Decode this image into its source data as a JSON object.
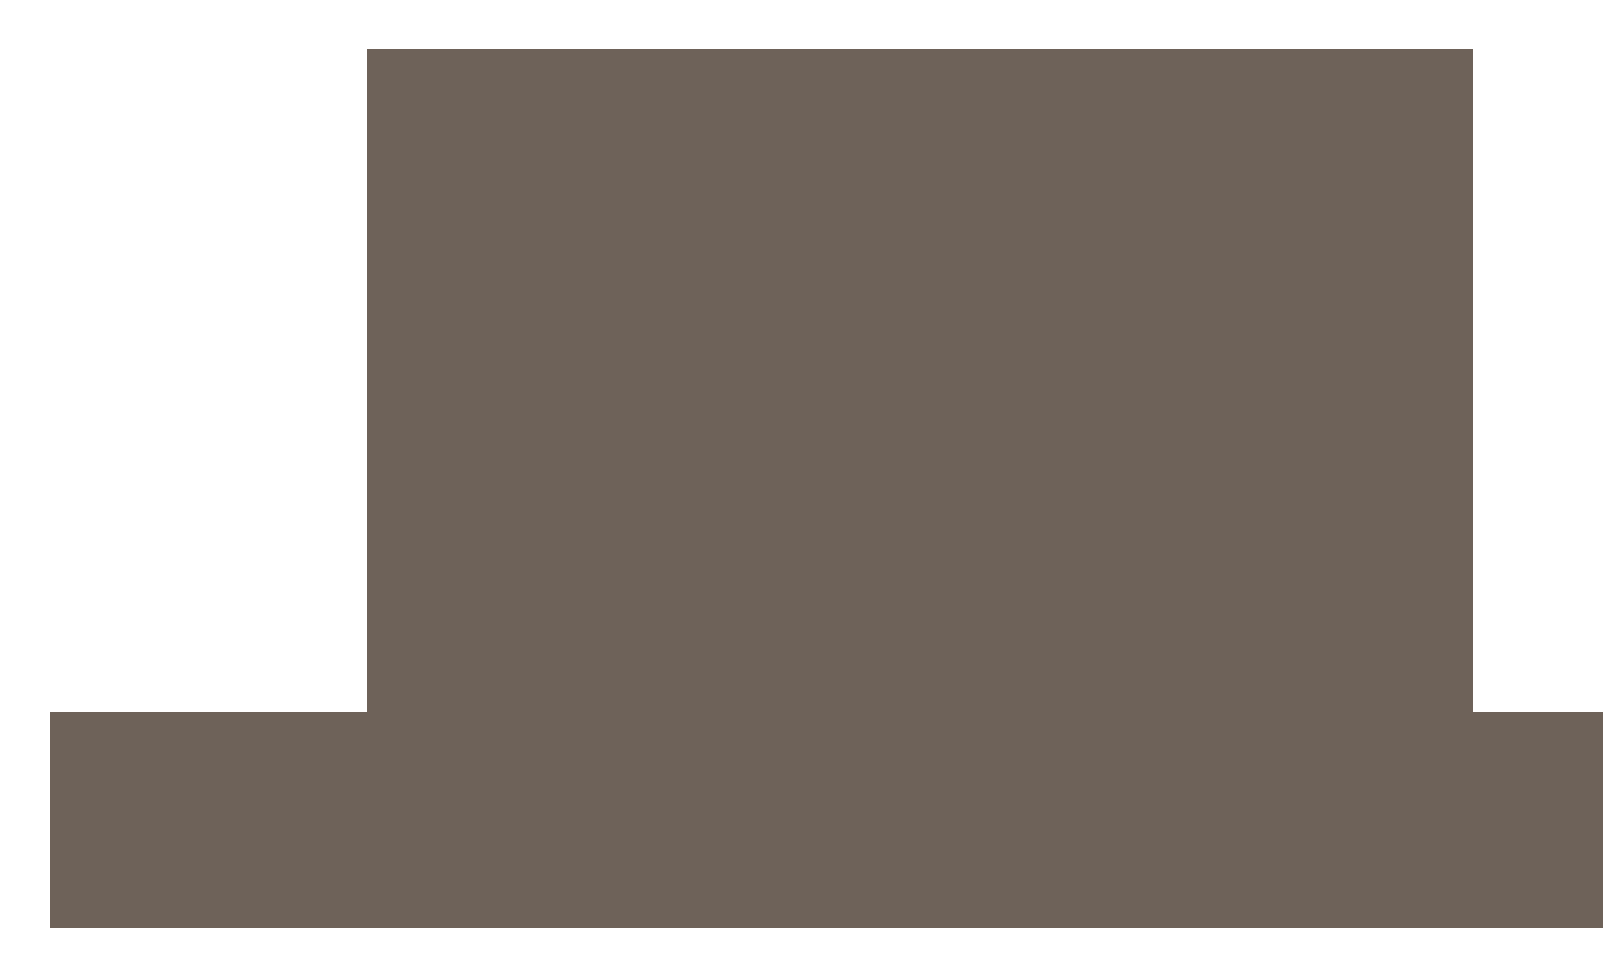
{
  "colors": {
    "background": "#ffffff",
    "silhouette": "#6e6259"
  },
  "shapes": {
    "screen_block": {
      "name": "silhouette-screen-block",
      "fill": "#6e6259"
    },
    "base_block": {
      "name": "silhouette-base-block",
      "fill": "#6e6259"
    }
  },
  "text_content": []
}
